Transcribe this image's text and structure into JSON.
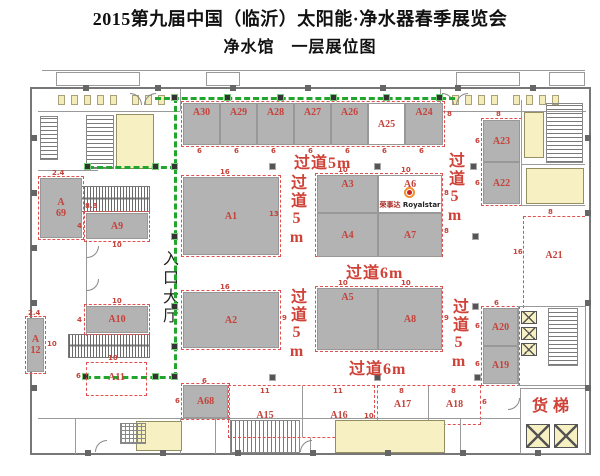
{
  "title": "2015第九届中国（临沂）太阳能·净水器春季展览会",
  "subtitle": "净水馆　一层展位图",
  "labels": {
    "entrance_hall": "入口大厅",
    "freight_elevator": "货梯",
    "aisle_5m": "过道5m",
    "aisle_6m": "过道6m"
  },
  "brand": {
    "cn": "荣事达",
    "en": "Royalstar"
  },
  "dims": {
    "d2_4": "2.4",
    "d4": "4",
    "d6": "6",
    "d8": "8",
    "d8_8": "8.8",
    "d9": "9",
    "d10": "10",
    "d11": "11",
    "d13": "13",
    "d16": "16"
  },
  "booths": {
    "a1": {
      "label": "A1"
    },
    "a2": {
      "label": "A2"
    },
    "a3": {
      "label": "A3"
    },
    "a4": {
      "label": "A4"
    },
    "a5": {
      "label": "A5"
    },
    "a6": {
      "label": "A6"
    },
    "a7": {
      "label": "A7"
    },
    "a8": {
      "label": "A8"
    },
    "a9": {
      "label": "A9"
    },
    "a10": {
      "label": "A10"
    },
    "a11": {
      "label": "A11"
    },
    "a12": {
      "l1": "A",
      "l2": "12"
    },
    "a15": {
      "label": "A15"
    },
    "a16": {
      "label": "A16"
    },
    "a17": {
      "label": "A17"
    },
    "a18": {
      "label": "A18"
    },
    "a19": {
      "label": "A19"
    },
    "a20": {
      "label": "A20"
    },
    "a21": {
      "label": "A21"
    },
    "a22": {
      "label": "A22"
    },
    "a23": {
      "label": "A23"
    },
    "a24": {
      "label": "A24"
    },
    "a25": {
      "label": "A25"
    },
    "a26": {
      "label": "A26"
    },
    "a27": {
      "label": "A27"
    },
    "a28": {
      "label": "A28"
    },
    "a29": {
      "label": "A29"
    },
    "a30": {
      "label": "A30"
    },
    "a68": {
      "label": "A68"
    },
    "a69": {
      "l1": "A",
      "l2": "69"
    }
  },
  "colors": {
    "booth_gray": "#b3b3b3",
    "accent_red": "#c5423a",
    "path_green": "#22a52c",
    "room_yellow": "#f6f0c2"
  }
}
